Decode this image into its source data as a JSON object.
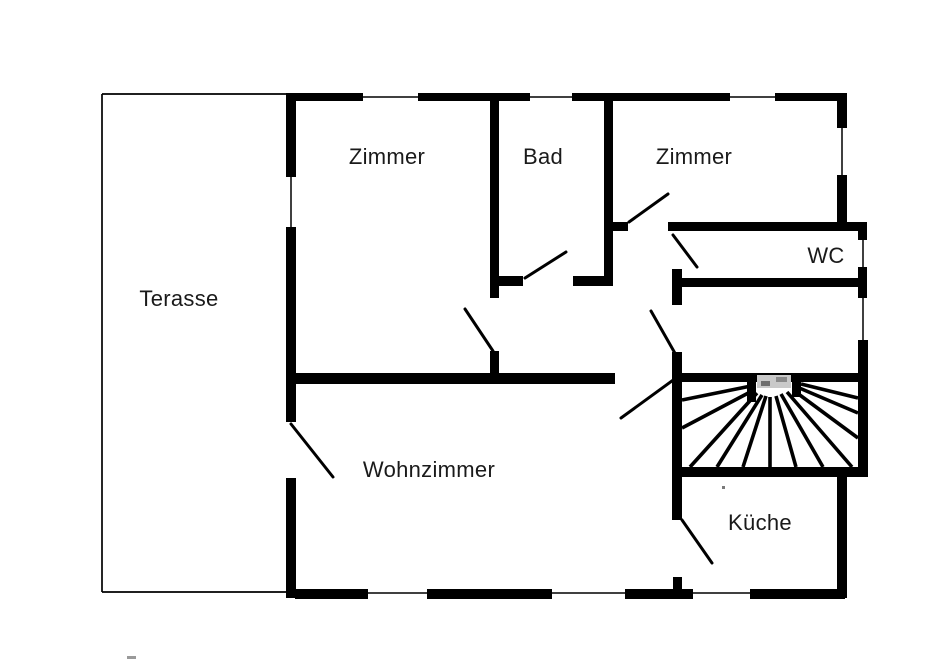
{
  "plan": {
    "colors": {
      "wall": "#000000",
      "label": "#1a1a1a",
      "background": "#ffffff"
    },
    "rooms": [
      {
        "id": "terasse",
        "label": "Terasse",
        "cx": 179,
        "cy": 299
      },
      {
        "id": "zimmer-left",
        "label": "Zimmer",
        "cx": 387,
        "cy": 157
      },
      {
        "id": "bad",
        "label": "Bad",
        "cx": 543,
        "cy": 157
      },
      {
        "id": "zimmer-right",
        "label": "Zimmer",
        "cx": 694,
        "cy": 157
      },
      {
        "id": "wc",
        "label": "WC",
        "cx": 826,
        "cy": 256
      },
      {
        "id": "wohnzimmer",
        "label": "Wohnzimmer",
        "cx": 429,
        "cy": 470
      },
      {
        "id": "kueche",
        "label": "Küche",
        "cx": 760,
        "cy": 523
      }
    ],
    "walls": [
      {
        "x": 287,
        "y": 93,
        "w": 76,
        "h": 8
      },
      {
        "x": 418,
        "y": 93,
        "w": 112,
        "h": 8
      },
      {
        "x": 572,
        "y": 93,
        "w": 158,
        "h": 8
      },
      {
        "x": 775,
        "y": 93,
        "w": 72,
        "h": 8
      },
      {
        "x": 286,
        "y": 93,
        "w": 10,
        "h": 84
      },
      {
        "x": 286,
        "y": 227,
        "w": 10,
        "h": 195
      },
      {
        "x": 286,
        "y": 478,
        "w": 10,
        "h": 120
      },
      {
        "x": 295,
        "y": 589,
        "w": 73,
        "h": 10
      },
      {
        "x": 427,
        "y": 589,
        "w": 125,
        "h": 10
      },
      {
        "x": 625,
        "y": 589,
        "w": 68,
        "h": 10
      },
      {
        "x": 750,
        "y": 589,
        "w": 95,
        "h": 10
      },
      {
        "x": 837,
        "y": 95,
        "w": 10,
        "h": 33
      },
      {
        "x": 837,
        "y": 175,
        "w": 10,
        "h": 47
      },
      {
        "x": 668,
        "y": 222,
        "w": 199,
        "h": 9
      },
      {
        "x": 858,
        "y": 222,
        "w": 9,
        "h": 18
      },
      {
        "x": 858,
        "y": 267,
        "w": 9,
        "h": 31
      },
      {
        "x": 680,
        "y": 278,
        "w": 178,
        "h": 9
      },
      {
        "x": 858,
        "y": 340,
        "w": 10,
        "h": 137
      },
      {
        "x": 837,
        "y": 472,
        "w": 10,
        "h": 126
      },
      {
        "x": 490,
        "y": 93,
        "w": 9,
        "h": 205
      },
      {
        "x": 490,
        "y": 351,
        "w": 9,
        "h": 27
      },
      {
        "x": 604,
        "y": 95,
        "w": 9,
        "h": 191
      },
      {
        "x": 498,
        "y": 276,
        "w": 25,
        "h": 10
      },
      {
        "x": 573,
        "y": 276,
        "w": 40,
        "h": 10
      },
      {
        "x": 604,
        "y": 222,
        "w": 24,
        "h": 9
      },
      {
        "x": 672,
        "y": 269,
        "w": 10,
        "h": 36
      },
      {
        "x": 672,
        "y": 352,
        "w": 10,
        "h": 168
      },
      {
        "x": 673,
        "y": 577,
        "w": 9,
        "h": 21
      },
      {
        "x": 286,
        "y": 373,
        "w": 329,
        "h": 11
      },
      {
        "x": 673,
        "y": 373,
        "w": 194,
        "h": 9
      },
      {
        "x": 682,
        "y": 467,
        "w": 185,
        "h": 10
      },
      {
        "x": 747,
        "y": 373,
        "w": 9,
        "h": 29
      },
      {
        "x": 792,
        "y": 376,
        "w": 9,
        "h": 21
      }
    ],
    "terrace_outline": [
      {
        "x1": 102,
        "y1": 94,
        "x2": 288,
        "y2": 94
      },
      {
        "x1": 102,
        "y1": 94,
        "x2": 102,
        "y2": 592
      },
      {
        "x1": 102,
        "y1": 592,
        "x2": 296,
        "y2": 592
      }
    ],
    "windows": [
      {
        "x1": 363,
        "y1": 97,
        "x2": 418,
        "y2": 97
      },
      {
        "x1": 530,
        "y1": 97,
        "x2": 572,
        "y2": 97
      },
      {
        "x1": 730,
        "y1": 97,
        "x2": 775,
        "y2": 97
      },
      {
        "x1": 291,
        "y1": 177,
        "x2": 291,
        "y2": 227
      },
      {
        "x1": 842,
        "y1": 128,
        "x2": 842,
        "y2": 175
      },
      {
        "x1": 863,
        "y1": 240,
        "x2": 863,
        "y2": 267
      },
      {
        "x1": 863,
        "y1": 298,
        "x2": 863,
        "y2": 340
      },
      {
        "x1": 368,
        "y1": 593,
        "x2": 427,
        "y2": 593
      },
      {
        "x1": 552,
        "y1": 593,
        "x2": 625,
        "y2": 593
      },
      {
        "x1": 693,
        "y1": 593,
        "x2": 750,
        "y2": 593
      }
    ],
    "door_swings": [
      {
        "x1": 291,
        "y1": 424,
        "x2": 333,
        "y2": 477
      },
      {
        "x1": 465,
        "y1": 309,
        "x2": 493,
        "y2": 351
      },
      {
        "x1": 525,
        "y1": 278,
        "x2": 566,
        "y2": 252
      },
      {
        "x1": 629,
        "y1": 222,
        "x2": 668,
        "y2": 194
      },
      {
        "x1": 673,
        "y1": 235,
        "x2": 697,
        "y2": 267
      },
      {
        "x1": 651,
        "y1": 311,
        "x2": 676,
        "y2": 355
      },
      {
        "x1": 621,
        "y1": 418,
        "x2": 676,
        "y2": 378
      },
      {
        "x1": 682,
        "y1": 520,
        "x2": 712,
        "y2": 563
      }
    ],
    "stairs": {
      "treads": [
        {
          "x1": 751,
          "y1": 386,
          "x2": 682,
          "y2": 400
        },
        {
          "x1": 754,
          "y1": 390,
          "x2": 682,
          "y2": 428
        },
        {
          "x1": 757,
          "y1": 393,
          "x2": 690,
          "y2": 467
        },
        {
          "x1": 762,
          "y1": 395,
          "x2": 717,
          "y2": 467
        },
        {
          "x1": 766,
          "y1": 396,
          "x2": 743,
          "y2": 467
        },
        {
          "x1": 770,
          "y1": 397,
          "x2": 770,
          "y2": 467
        },
        {
          "x1": 776,
          "y1": 396,
          "x2": 796,
          "y2": 467
        },
        {
          "x1": 781,
          "y1": 394,
          "x2": 823,
          "y2": 467
        },
        {
          "x1": 787,
          "y1": 392,
          "x2": 852,
          "y2": 467
        },
        {
          "x1": 793,
          "y1": 390,
          "x2": 858,
          "y2": 438
        },
        {
          "x1": 797,
          "y1": 387,
          "x2": 858,
          "y2": 413
        },
        {
          "x1": 801,
          "y1": 384,
          "x2": 858,
          "y2": 398
        }
      ]
    },
    "noise_marks": [
      {
        "x": 757,
        "y": 375,
        "w": 34,
        "h": 13,
        "color": "#c9c9c9"
      },
      {
        "x": 761,
        "y": 381,
        "w": 9,
        "h": 5,
        "color": "#6e6e6e"
      },
      {
        "x": 776,
        "y": 377,
        "w": 11,
        "h": 5,
        "color": "#8a8a8a"
      },
      {
        "x": 127,
        "y": 656,
        "w": 9,
        "h": 3,
        "color": "#9a9a9a"
      },
      {
        "x": 722,
        "y": 486,
        "w": 3,
        "h": 3,
        "color": "#7a7a7a"
      }
    ]
  }
}
